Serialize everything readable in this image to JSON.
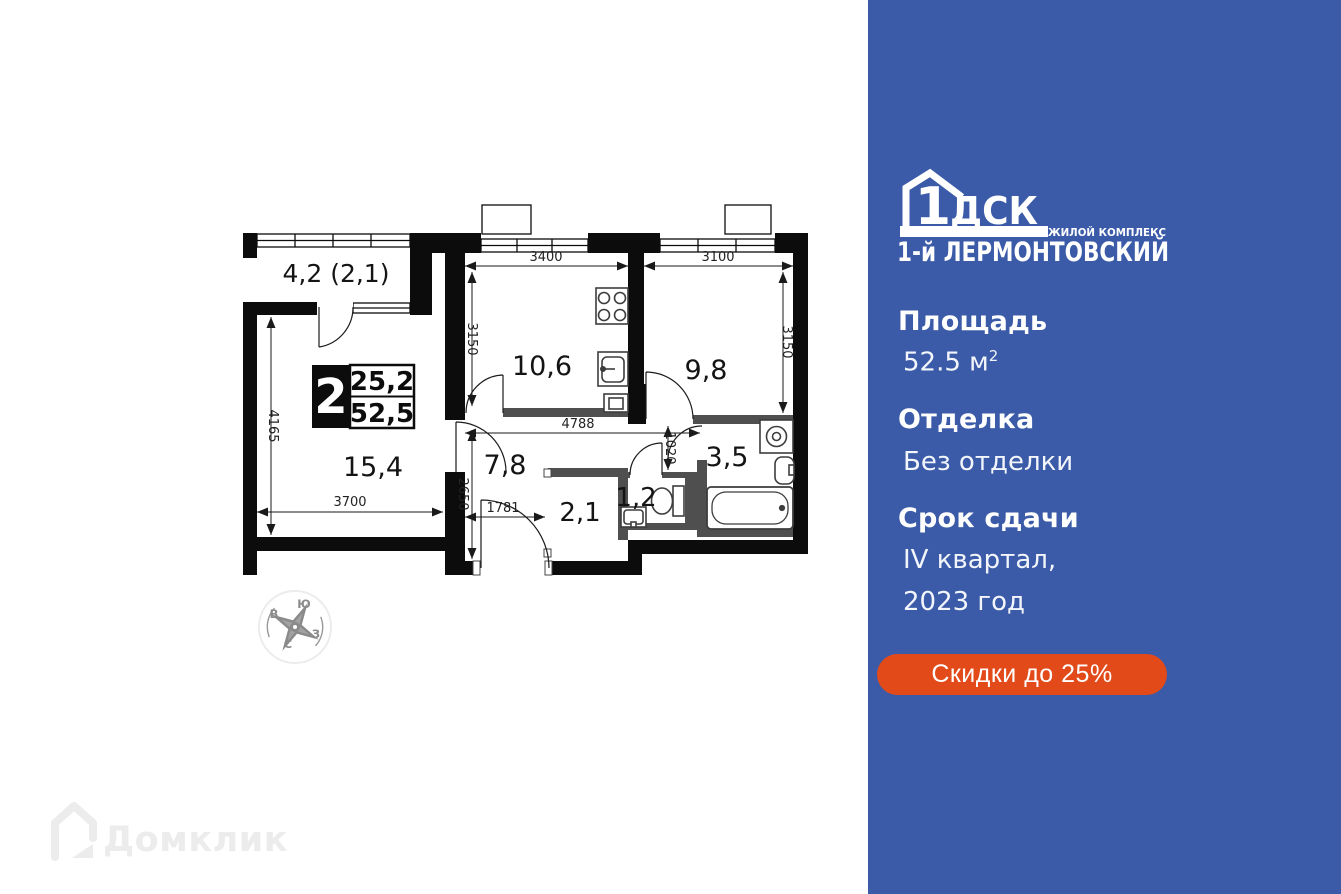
{
  "colors": {
    "panel_bg": "#3b5ba8",
    "accent": "#e24a19"
  },
  "panel": {
    "logo": {
      "number": "1",
      "letters": "ДСК",
      "tagline": "ЖИЛОЙ КОМПЛЕКС",
      "name": "1-й ЛЕРМОНТОВСКИЙ"
    },
    "area": {
      "label": "Площадь",
      "value": "52.5 м",
      "sup": "2"
    },
    "finish": {
      "label": "Отделка",
      "value": "Без отделки"
    },
    "deadline": {
      "label": "Срок сдачи",
      "line1": "IV квартал,",
      "line2": "2023 год"
    },
    "discount": "Скидки до 25%"
  },
  "plan": {
    "badge": {
      "rooms": "2",
      "living_area": "25,2",
      "total_area": "52,5"
    },
    "labels": {
      "balcony": "4,2 (2,1)",
      "living": "15,4",
      "kitchen": "10,6",
      "bedroom": "9,8",
      "hallway": "7,8",
      "closet": "2,1",
      "wc": "1,2",
      "bathroom": "3,5"
    },
    "dims": {
      "kitchen_w": "3400",
      "bedroom_w": "3100",
      "kitchen_h": "3150",
      "bedroom_h": "3150",
      "living_h": "4165",
      "living_w": "3700",
      "hall_h": "2650",
      "hall_w": "1781",
      "hall_total": "4788",
      "nook": "1020"
    }
  },
  "compass": {
    "top": "Ю",
    "left": "В",
    "right": "З",
    "bottom": "С"
  },
  "watermark": "Домклик"
}
